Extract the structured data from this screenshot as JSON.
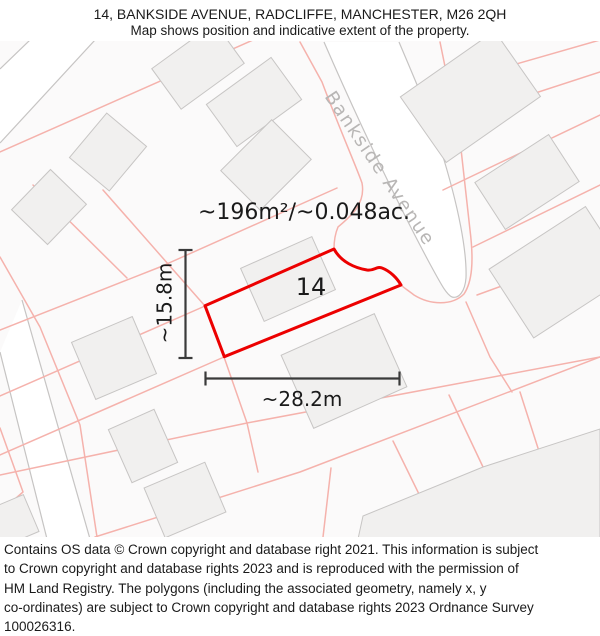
{
  "header": {
    "title": "14, BANKSIDE AVENUE, RADCLIFFE, MANCHESTER, M26 2QH",
    "subtitle": "Map shows position and indicative extent of the property."
  },
  "map": {
    "area_label": "~196m²/~0.048ac.",
    "plot_number": "14",
    "width_label": "~28.2m",
    "height_label": "~15.8m",
    "road_name": "Bankside Avenue",
    "colors": {
      "plot_outline": "#ec0000",
      "parcel_line": "#f5b2ac",
      "building_fill": "#f1f0ef",
      "building_stroke": "#c7c5c4",
      "road_edge": "#c6c4c3",
      "road_label": "#b8b6b5",
      "dimension_line": "#3a3a3a",
      "text": "#1a1a1a"
    }
  },
  "footer": {
    "lines": [
      "Contains OS data © Crown copyright and database right 2021. This information is subject",
      "to Crown copyright and database rights 2023 and is reproduced with the permission of",
      "HM Land Registry. The polygons (including the associated geometry, namely x, y",
      "co-ordinates) are subject to Crown copyright and database rights 2023 Ordnance Survey",
      "100026316."
    ]
  }
}
